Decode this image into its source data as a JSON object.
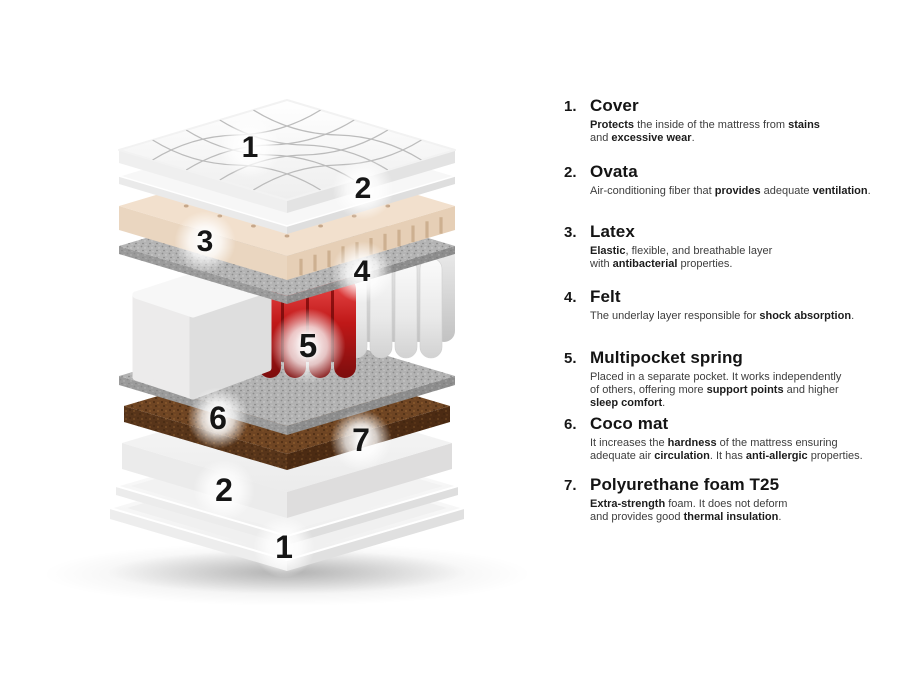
{
  "diagram": {
    "badges": [
      "1",
      "2",
      "3",
      "4",
      "5",
      "6",
      "7",
      "2",
      "1"
    ],
    "colors": {
      "spring_red": "#c01818",
      "latex_beige": "#f2e0cd",
      "felt_gray": "#b4b4b4",
      "coco_brown": "#6f4523"
    }
  },
  "legend": {
    "items": [
      {
        "number": "1.",
        "title": "Cover",
        "desc": [
          {
            "t": "Protects",
            "b": true
          },
          {
            "t": " the inside of the mattress from "
          },
          {
            "t": "stains",
            "b": true
          },
          {
            "t": "\nand "
          },
          {
            "t": "excessive wear",
            "b": true
          },
          {
            "t": "."
          }
        ]
      },
      {
        "number": "2.",
        "title": "Ovata",
        "desc": [
          {
            "t": "Air-conditioning fiber that "
          },
          {
            "t": "provides",
            "b": true
          },
          {
            "t": " adequate "
          },
          {
            "t": "ventilation",
            "b": true
          },
          {
            "t": "."
          }
        ]
      },
      {
        "number": "3.",
        "title": "Latex",
        "desc": [
          {
            "t": "Elastic",
            "b": true
          },
          {
            "t": ", flexible, and breathable layer\nwith "
          },
          {
            "t": "antibacterial",
            "b": true
          },
          {
            "t": " properties."
          }
        ]
      },
      {
        "number": "4.",
        "title": "Felt",
        "desc": [
          {
            "t": "The underlay layer responsible for "
          },
          {
            "t": "shock absorption",
            "b": true
          },
          {
            "t": "."
          }
        ]
      },
      {
        "number": "5.",
        "title": "Multipocket spring",
        "desc": [
          {
            "t": "Placed in a separate pocket. It works independently\nof others, offering more "
          },
          {
            "t": "support points",
            "b": true
          },
          {
            "t": " and higher\n"
          },
          {
            "t": "sleep comfort",
            "b": true
          },
          {
            "t": "."
          }
        ]
      },
      {
        "number": "6.",
        "title": "Coco mat",
        "desc": [
          {
            "t": "It increases the "
          },
          {
            "t": "hardness",
            "b": true
          },
          {
            "t": " of the mattress ensuring\nadequate air "
          },
          {
            "t": "circulation",
            "b": true
          },
          {
            "t": ". It has "
          },
          {
            "t": "anti-allergic",
            "b": true
          },
          {
            "t": " properties."
          }
        ]
      },
      {
        "number": "7.",
        "title": "Polyurethane foam T25",
        "desc": [
          {
            "t": "Extra-strength",
            "b": true
          },
          {
            "t": " foam. It does not deform\nand provides good "
          },
          {
            "t": "thermal insulation",
            "b": true
          },
          {
            "t": "."
          }
        ]
      }
    ]
  }
}
